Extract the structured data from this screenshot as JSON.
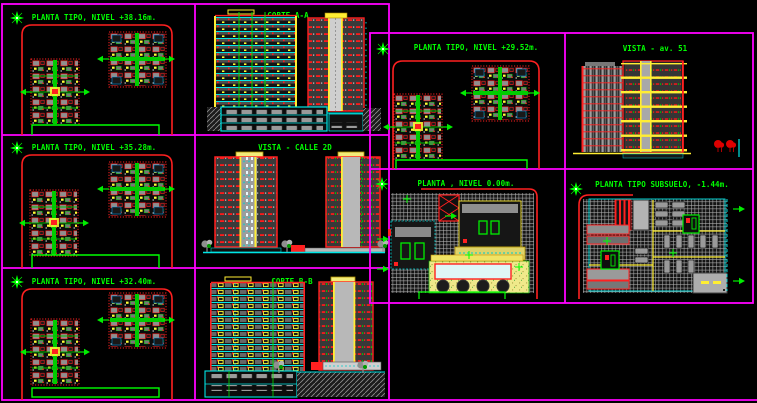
{
  "drawing": {
    "sheet_name": "apartment-tower-cad-sheet",
    "background": "#000000",
    "colors": {
      "frame": "#ff00ff",
      "title_text": "#00ff00",
      "outline_red": "#ff2020",
      "floor_cyan": "#00e5e5",
      "core_yellow": "#ffee33",
      "plan_green": "#00cc00",
      "facade_gray": "#3a3a3a"
    },
    "panels": [
      {
        "id": "planta-38",
        "title": "PLANTA TIPO, NIVEL +38.16m."
      },
      {
        "id": "corte-aa",
        "title": "CORTE A-A"
      },
      {
        "id": "planta-35",
        "title": "PLANTA TIPO, NIVEL +35.28m."
      },
      {
        "id": "vista-calle",
        "title": "VISTA - CALLE 2D"
      },
      {
        "id": "planta-32",
        "title": "PLANTA TIPO, NIVEL +32.40m."
      },
      {
        "id": "corte-bb",
        "title": "CORTE B-B"
      },
      {
        "id": "planta-29",
        "title": "PLANTA TIPO, NIVEL +29.52m."
      },
      {
        "id": "vista-av51",
        "title": "VISTA - av. 51"
      },
      {
        "id": "planta-0",
        "title": "PLANTA , NIVEL 0.00m."
      },
      {
        "id": "planta-sub",
        "title": "PLANTA TIPO SUBSUELO, -1.44m."
      }
    ]
  }
}
